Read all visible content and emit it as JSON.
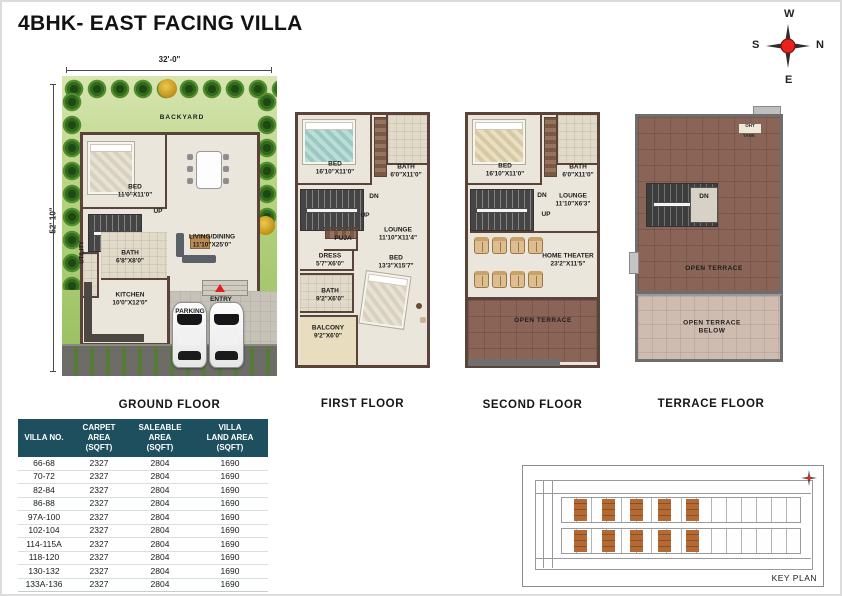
{
  "title": "4BHK- EAST FACING VILLA",
  "compass": {
    "n": "N",
    "s": "S",
    "e": "E",
    "w": "W"
  },
  "dimensions": {
    "plot_width": "32'-0\"",
    "plot_depth": "52'-10\""
  },
  "floors": {
    "ground": {
      "label": "GROUND FLOOR",
      "backyard": "BACKYARD",
      "bed": {
        "name": "BED",
        "dim": "11'0\"X11'0\""
      },
      "living": {
        "name": "LIVING/DINING",
        "dim": "11'10\"X25'0\""
      },
      "up": "UP",
      "utility": "UTILITY",
      "bath": {
        "name": "BATH",
        "dim": "6'8\"X8'0\""
      },
      "kitchen": {
        "name": "KITCHEN",
        "dim": "10'0\"X12'0\""
      },
      "entry": "ENTRY",
      "parking": "PARKING"
    },
    "first": {
      "label": "FIRST FLOOR",
      "bed1": {
        "name": "BED",
        "dim": "16'10\"X11'0\""
      },
      "bath1": {
        "name": "BATH",
        "dim": "6'0\"X11'0\""
      },
      "dn": "DN",
      "up": "UP",
      "puja": "PUJA",
      "lounge": {
        "name": "LOUNGE",
        "dim": "11'10\"X11'4\""
      },
      "dress": {
        "name": "DRESS",
        "dim": "5'7\"X6'0\""
      },
      "bed2": {
        "name": "BED",
        "dim": "13'3\"X15'7\""
      },
      "bath2": {
        "name": "BATH",
        "dim": "9'2\"X6'0\""
      },
      "balcony": {
        "name": "BALCONY",
        "dim": "9'2\"X6'0\""
      }
    },
    "second": {
      "label": "SECOND FLOOR",
      "bed": {
        "name": "BED",
        "dim": "16'10\"X11'0\""
      },
      "bath": {
        "name": "BATH",
        "dim": "6'0\"X11'0\""
      },
      "dn": "DN",
      "up": "UP",
      "lounge": {
        "name": "LOUNGE",
        "dim": "11'10\"X6'3\""
      },
      "home_theater": {
        "name": "HOME THEATER",
        "dim": "23'2\"X11'5\""
      },
      "open_terrace": "OPEN TERRACE"
    },
    "terrace": {
      "label": "TERRACE  FLOOR",
      "dn": "DN",
      "oht": "OHT",
      "tank": "TANK",
      "open_terrace": "OPEN TERRACE",
      "open_terrace_below": "OPEN TERRACE\nBELOW"
    }
  },
  "table": {
    "headers": [
      "VILLA NO.",
      "CARPET AREA\n(SQFT)",
      "SALEABLE AREA\n(SQFT)",
      "VILLA\nLAND AREA\n(SQFT)"
    ],
    "rows": [
      [
        "66-68",
        "2327",
        "2804",
        "1690"
      ],
      [
        "70-72",
        "2327",
        "2804",
        "1690"
      ],
      [
        "82-84",
        "2327",
        "2804",
        "1690"
      ],
      [
        "86-88",
        "2327",
        "2804",
        "1690"
      ],
      [
        "97A-100",
        "2327",
        "2804",
        "1690"
      ],
      [
        "102-104",
        "2327",
        "2804",
        "1690"
      ],
      [
        "114-115A",
        "2327",
        "2804",
        "1690"
      ],
      [
        "118-120",
        "2327",
        "2804",
        "1690"
      ],
      [
        "130-132",
        "2327",
        "2804",
        "1690"
      ],
      [
        "133A-136",
        "2327",
        "2804",
        "1690"
      ]
    ]
  },
  "key_plan": {
    "label": "KEY PLAN"
  },
  "colors": {
    "table_header_teal": "#1e4f5f",
    "highlight_orange": "#b46a34",
    "terrace_brick": "#8a6456",
    "wall_brown": "#5a443a",
    "entry_marker_red": "#e0201c",
    "grass_green": "#9cc163"
  }
}
